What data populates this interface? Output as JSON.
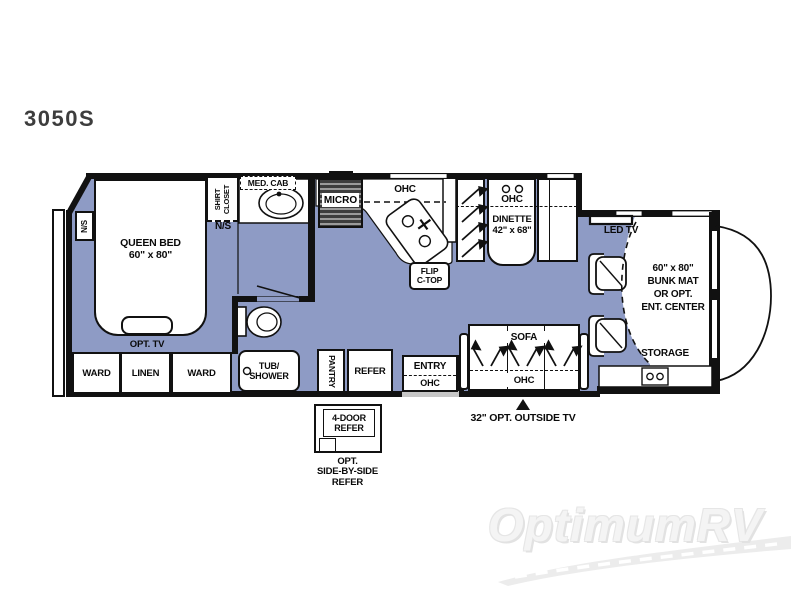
{
  "title": "3050S",
  "colors": {
    "floor": "#8e9bc5",
    "wall": "#111111",
    "steps_gray": "#c6c6c6",
    "watermark": "#f4f4f4"
  },
  "bedroom": {
    "nightstand_left_label": "N/S",
    "bed_label_line1": "QUEEN BED",
    "bed_label_line2": "60\" x 80\"",
    "shirt_closet_label": "SHIRT CLOSET",
    "nightstand_right_label": "N/S",
    "opt_tv_label": "OPT. TV",
    "ward_left_label": "WARD",
    "linen_label": "LINEN",
    "ward_right_label": "WARD"
  },
  "bathroom": {
    "med_cab_label": "MED. CAB",
    "tub_shower_line1": "TUB/",
    "tub_shower_line2": "SHOWER"
  },
  "kitchen": {
    "micro_label": "MICRO",
    "ohc_label": "OHC",
    "flip_ctop_line1": "FLIP",
    "flip_ctop_line2": "C-TOP",
    "pantry_label": "PANTRY",
    "refer_label": "REFER"
  },
  "dinette": {
    "ohc_label": "OHC",
    "name_label": "DINETTE",
    "size_label": "42\" x 68\""
  },
  "living": {
    "sofa_label": "SOFA",
    "sofa_ohc_label": "OHC",
    "entry_label": "ENTRY",
    "entry_ohc_label": "OHC"
  },
  "cab": {
    "led_tv_label": "LED TV",
    "bunk_line1": "60\" x 80\"",
    "bunk_line2": "BUNK MAT",
    "bunk_line3": "OR OPT.",
    "bunk_line4": "ENT. CENTER",
    "storage_label": "STORAGE"
  },
  "options": {
    "four_door_refer_line1": "4-DOOR",
    "four_door_refer_line2": "REFER",
    "opt_refer_line1": "OPT.",
    "opt_refer_line2": "SIDE-BY-SIDE",
    "opt_refer_line3": "REFER",
    "outside_tv_label": "32\" OPT. OUTSIDE TV"
  },
  "watermark": "OptimumRV"
}
